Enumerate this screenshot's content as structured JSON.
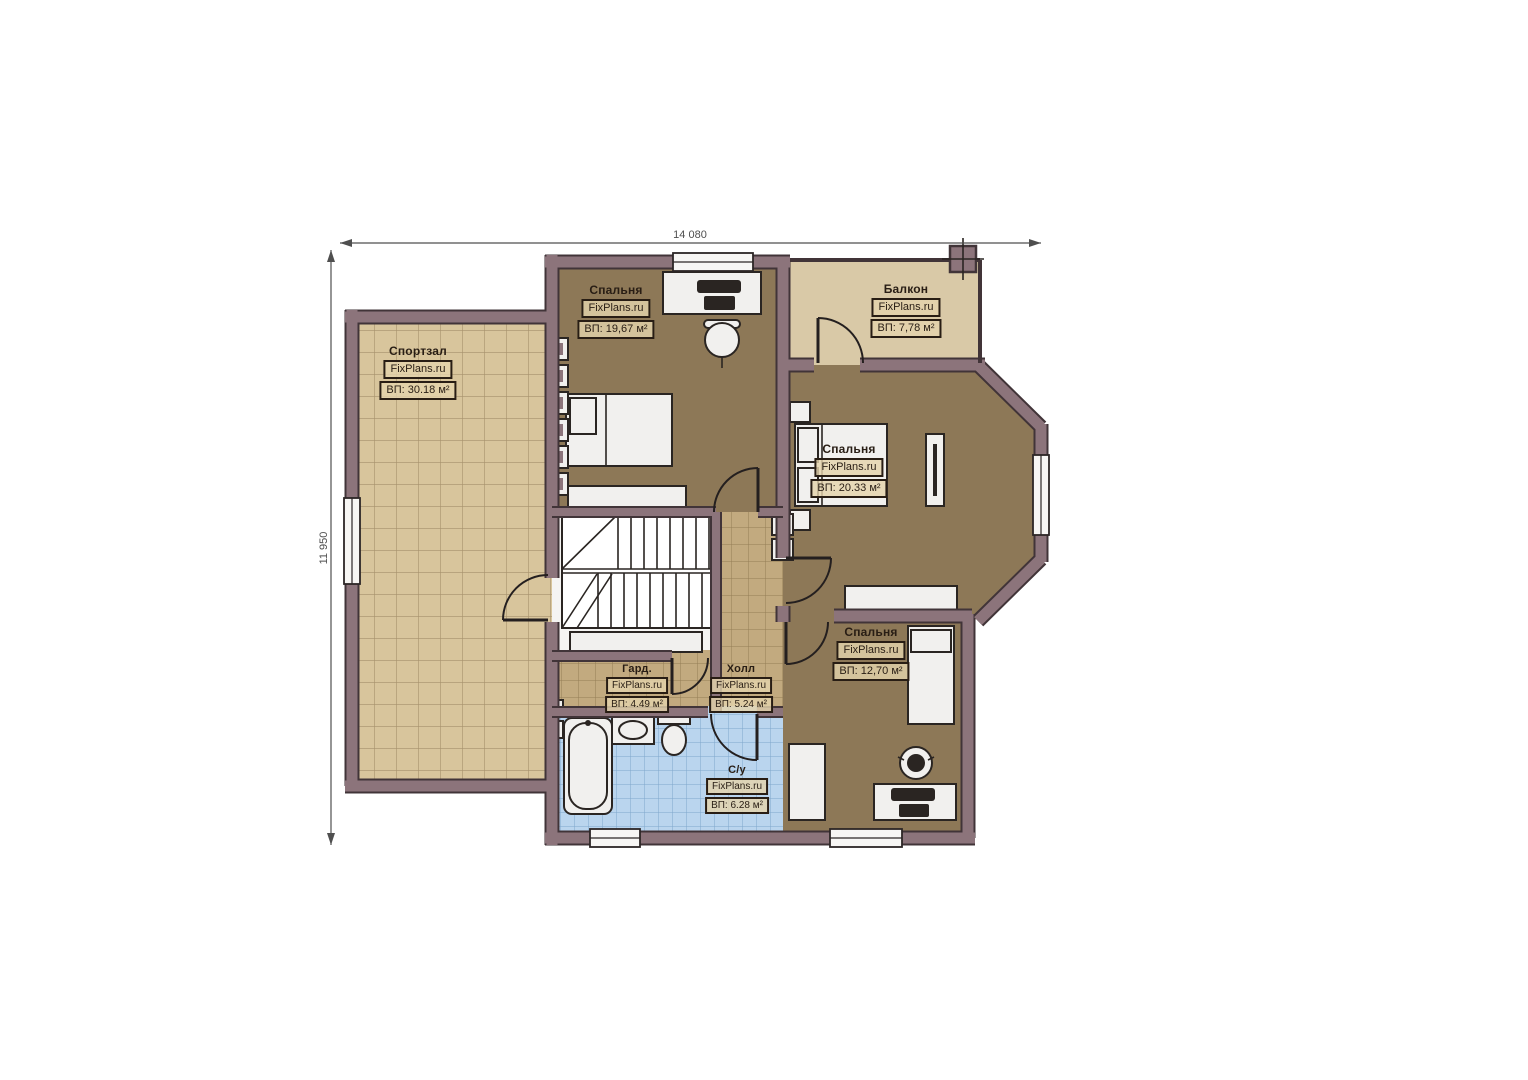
{
  "dimensions": {
    "horizontal": "14 080",
    "vertical": "11 950"
  },
  "rooms": [
    {
      "id": "gym",
      "name": "Спортзал",
      "site": "FixPlans.ru",
      "area": "ВП: 30.18 м²"
    },
    {
      "id": "bedroom-top",
      "name": "Спальня",
      "site": "FixPlans.ru",
      "area": "ВП: 19,67 м²"
    },
    {
      "id": "balcony",
      "name": "Балкон",
      "site": "FixPlans.ru",
      "area": "ВП: 7,78 м²"
    },
    {
      "id": "bedroom-right",
      "name": "Спальня",
      "site": "FixPlans.ru",
      "area": "ВП: 20.33 м²"
    },
    {
      "id": "bedroom-bottom",
      "name": "Спальня",
      "site": "FixPlans.ru",
      "area": "ВП: 12,70 м²"
    },
    {
      "id": "wardrobe",
      "name": "Гард.",
      "site": "FixPlans.ru",
      "area": "ВП: 4.49 м²"
    },
    {
      "id": "hall",
      "name": "Холл",
      "site": "FixPlans.ru",
      "area": "ВП: 5.24 м²"
    },
    {
      "id": "bathroom",
      "name": "С/у",
      "site": "FixPlans.ru",
      "area": "ВП: 6.28 м²"
    }
  ],
  "colors": {
    "wall-fill": "#8c747b",
    "wall-edge": "#413438",
    "floor-bedroom": "#8d7857",
    "floor-balcony": "#d9c9a7",
    "gym-tile": "#d8c59c",
    "gym-tile-line": "#a6916c",
    "hall-tile": "#c2aa7f",
    "hall-tile-line": "#947d56",
    "bath-tile": "#bad5ee",
    "bath-tile-line": "#7fa6cc",
    "furn-fill": "#f1f0ee",
    "furn-edge": "#2a2522",
    "stair-bg": "#f5f4f2",
    "label-bg": "rgba(228,211,172,0.82)",
    "label-edge": "#281d14",
    "label-text": "#281d14",
    "dim-color": "#4f4f4f"
  }
}
